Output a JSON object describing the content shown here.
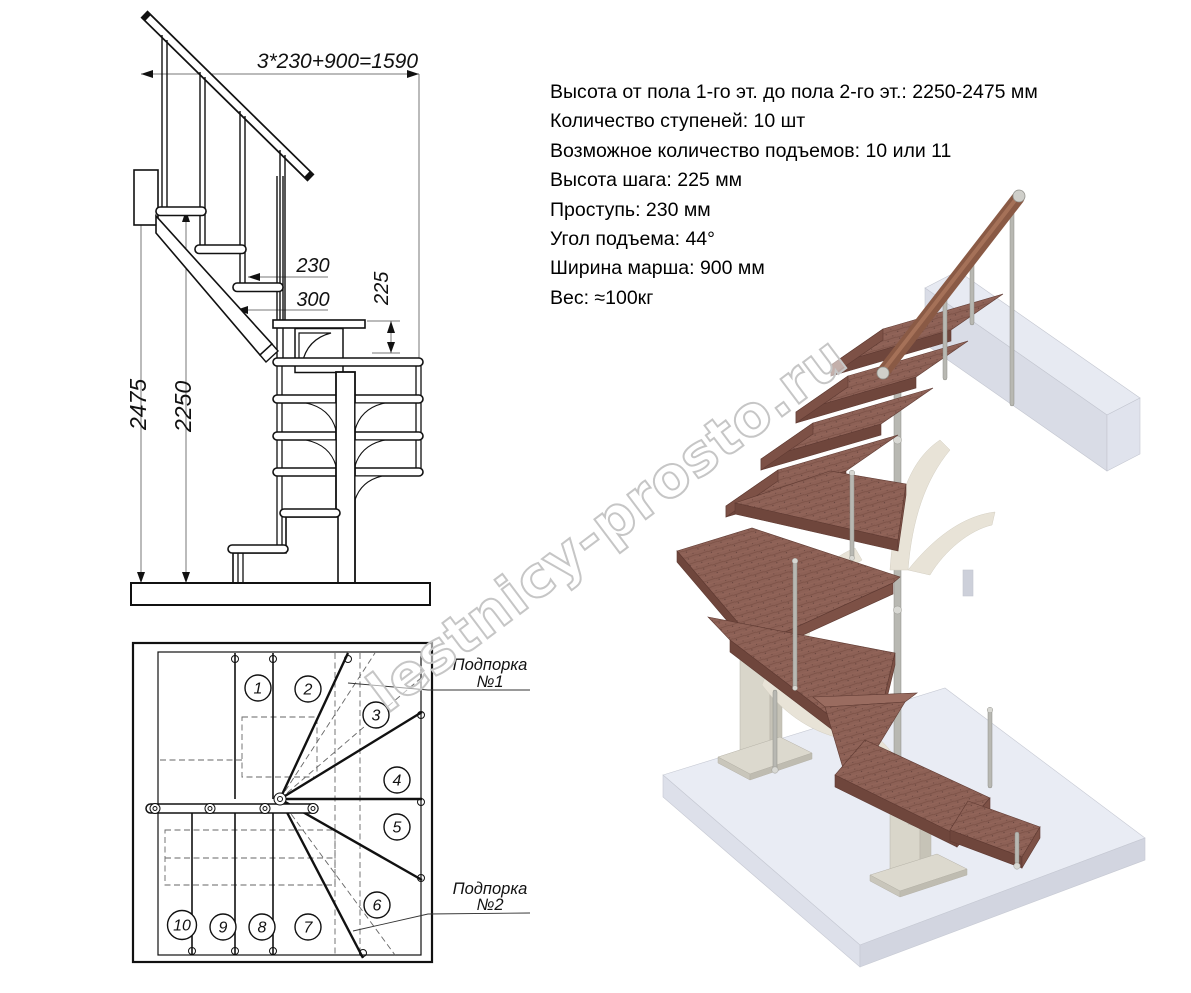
{
  "specs": {
    "lines": [
      "Высота от пола 1-го эт. до пола 2-го эт.: 2250-2475 мм",
      "Количество ступеней: 10 шт",
      "Возможное количество подъемов: 10 или 11",
      "Высота шага: 225 мм",
      "Проступь: 230 мм",
      "Угол подъема: 44°",
      "Ширина марша: 900 мм",
      "Вес: ≈100кг"
    ]
  },
  "side_view": {
    "dim_total": "3*230+900=1590",
    "dim_tread": "230",
    "dim_depth": "300",
    "dim_riser": "225",
    "dim_height_max": "2475",
    "dim_height_min": "2250"
  },
  "plan_view": {
    "steps": [
      "1",
      "2",
      "3",
      "4",
      "5",
      "6",
      "7",
      "8",
      "9",
      "10"
    ],
    "support_1": {
      "line1": "Подпорка",
      "line2": "№1"
    },
    "support_2": {
      "line1": "Подпорка",
      "line2": "№2"
    }
  },
  "watermark": {
    "text": "lestnicy-prosto.ru"
  },
  "colors": {
    "drawing_line": "#111111",
    "dimension_line": "#777777",
    "tread_wood": "#8d6156",
    "tread_front": "#6f463c",
    "handrail_wood": "#8a5a45",
    "metal": "#b8b8b2",
    "column": "#d9d6ca",
    "floor_top": "#e9ecf4",
    "watermark_gray": "#c6c6c6"
  }
}
